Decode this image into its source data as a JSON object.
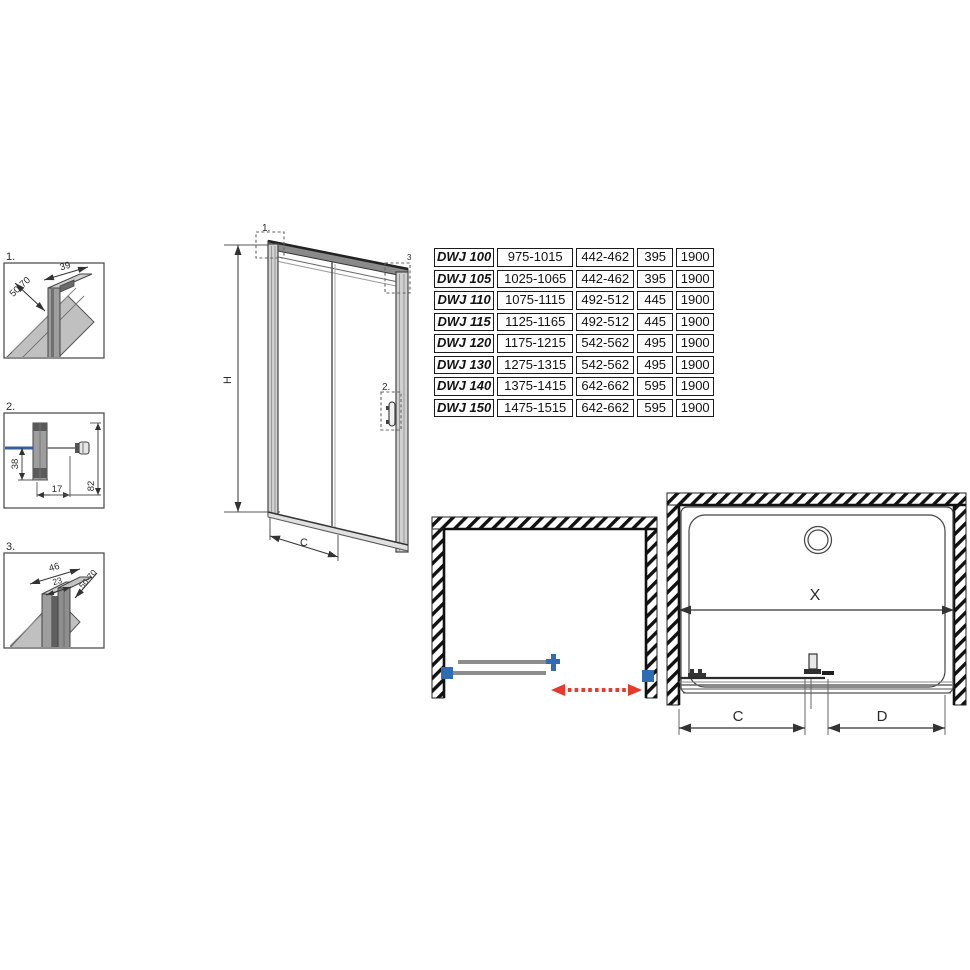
{
  "colors": {
    "line": "#3a3a3a",
    "profile_gray": "#9e9e9e",
    "glass_blue": "#36609f",
    "fitting_blue": "#2e6db4",
    "dim_red": "#d83b2e",
    "arrow_red": "#e8392b",
    "dim_green": "#3faf49",
    "dim_purple": "#7030a0"
  },
  "details": {
    "d1": {
      "label": "1.",
      "dim_depth": "50-70",
      "dim_width": "39"
    },
    "d2": {
      "label": "2.",
      "dim_glass_offset": "38",
      "dim_profile": "17",
      "dim_total": "82"
    },
    "d3": {
      "label": "3.",
      "dim_outer": "46",
      "dim_inner": "23",
      "dim_depth": "50-70"
    }
  },
  "front_view": {
    "marker_top_left": "1.",
    "marker_top_right": "3",
    "marker_handle": "2.",
    "dim_height": "H",
    "dim_width": "C"
  },
  "spec_table": {
    "rows": [
      [
        "DWJ 100",
        "975-1015",
        "442-462",
        "395",
        "1900"
      ],
      [
        "DWJ 105",
        "1025-1065",
        "442-462",
        "395",
        "1900"
      ],
      [
        "DWJ 110",
        "1075-1115",
        "492-512",
        "445",
        "1900"
      ],
      [
        "DWJ 115",
        "1125-1165",
        "492-512",
        "445",
        "1900"
      ],
      [
        "DWJ 120",
        "1175-1215",
        "542-562",
        "495",
        "1900"
      ],
      [
        "DWJ 130",
        "1275-1315",
        "542-562",
        "495",
        "1900"
      ],
      [
        "DWJ 140",
        "1375-1415",
        "642-662",
        "595",
        "1900"
      ],
      [
        "DWJ 150",
        "1475-1515",
        "642-662",
        "595",
        "1900"
      ]
    ]
  },
  "plan_dimensions": {
    "x": "X",
    "c": "C",
    "d": "D"
  }
}
